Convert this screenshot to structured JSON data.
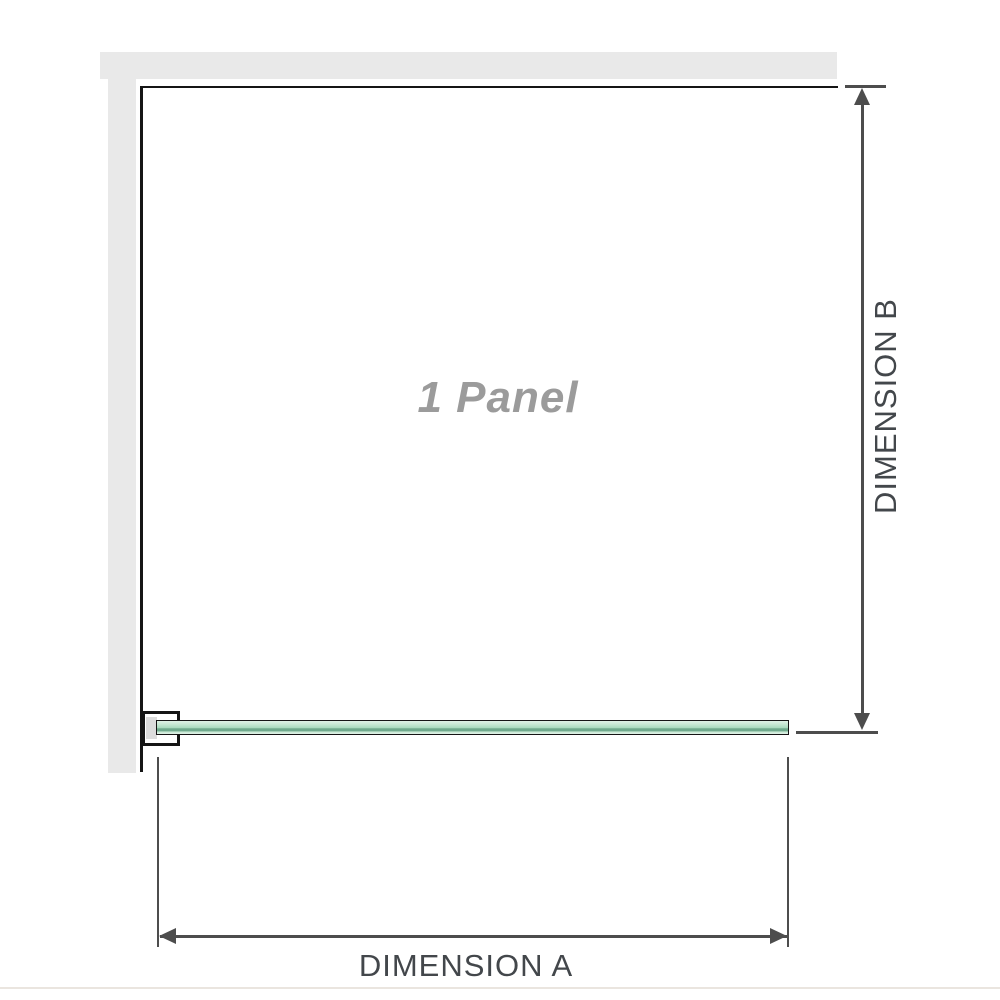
{
  "diagram": {
    "panel_label": "1 Panel",
    "dimension_a_label": "DIMENSION A",
    "dimension_b_label": "DIMENSION B"
  },
  "colors": {
    "wall": "#e9e9e9",
    "outline": "#151515",
    "dimension": "#4d4d4d",
    "label_text": "#43474b",
    "panel_text": "#9b9b9b",
    "clamp_pad": "#dcdcdc",
    "glass_light": "#e0f1e6",
    "glass_mid": "#a9dabd",
    "glass_dark": "#6fa98c",
    "glass_pale": "#c8e8d4",
    "baseline": "#eae5df"
  }
}
